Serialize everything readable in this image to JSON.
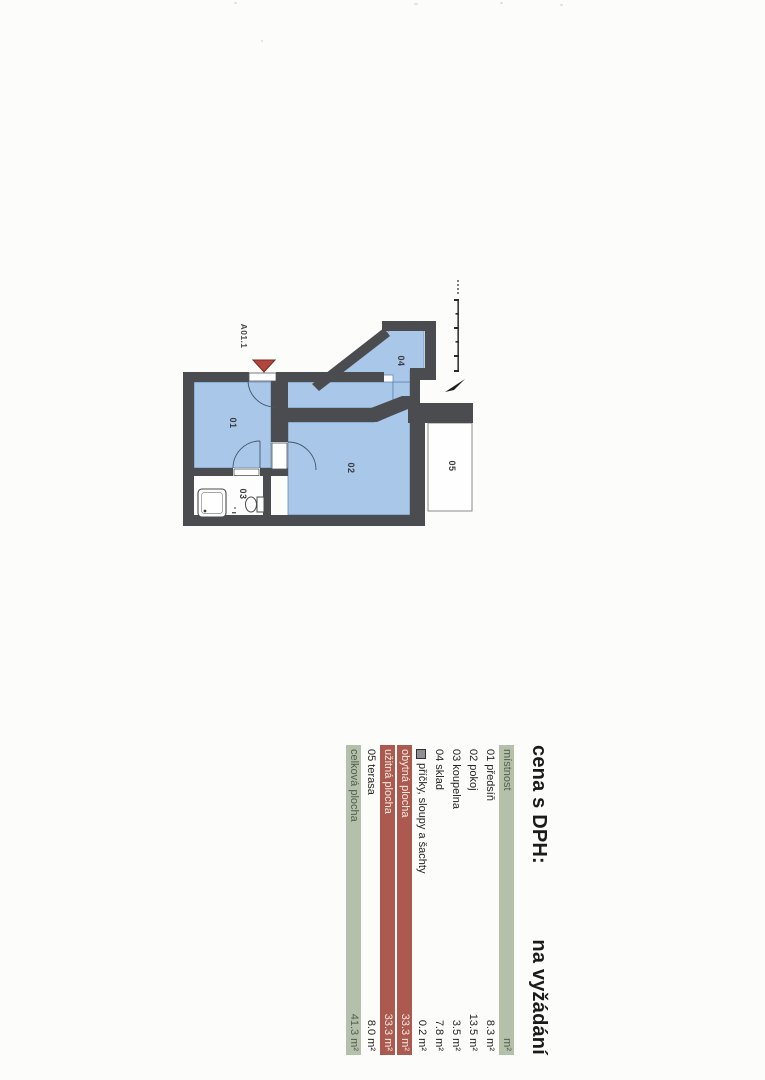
{
  "headline": {
    "left": "cena s DPH:",
    "right": "na vyžádání"
  },
  "legend": {
    "header": {
      "name": "místnost",
      "value": "m²"
    },
    "rows": [
      {
        "name": "01 předsíň",
        "value": "8.3 m²",
        "style": "white"
      },
      {
        "name": "02 pokoj",
        "value": "13.5 m²",
        "style": "white"
      },
      {
        "name": "03 koupelna",
        "value": "3.5 m²",
        "style": "white"
      },
      {
        "name": "04 sklad",
        "value": "7.8 m²",
        "style": "white"
      },
      {
        "name": "příčky, sloupy a šachty",
        "value": "0.2 m²",
        "style": "white",
        "icon": "wall-swatch"
      },
      {
        "name": "obytná plocha",
        "value": "33.3 m²",
        "style": "red"
      },
      {
        "name": "užitná plocha",
        "value": "33.3 m²",
        "style": "red"
      },
      {
        "name": "05 terasa",
        "value": "8.0 m²",
        "style": "white"
      },
      {
        "name": "celková plocha",
        "value": "41.3 m²",
        "style": "green"
      }
    ]
  },
  "plan": {
    "unit_label": "A01.1",
    "room_labels": [
      "01",
      "02",
      "03",
      "04",
      "05"
    ],
    "icons": [
      "entrance-arrow-icon",
      "north-arrow-icon",
      "scale-bar-icon",
      "shower-icon",
      "toilet-icon",
      "door-swing-icon"
    ]
  },
  "colors": {
    "wall": "#4b4c50",
    "room_fill": "#a9c7e9",
    "room_line": "#5d7fa8",
    "entrance_arrow": "#b0463c",
    "legend_green": "#b4c0aa",
    "legend_red": "#ac594f",
    "paper": "#fcfcfb"
  }
}
